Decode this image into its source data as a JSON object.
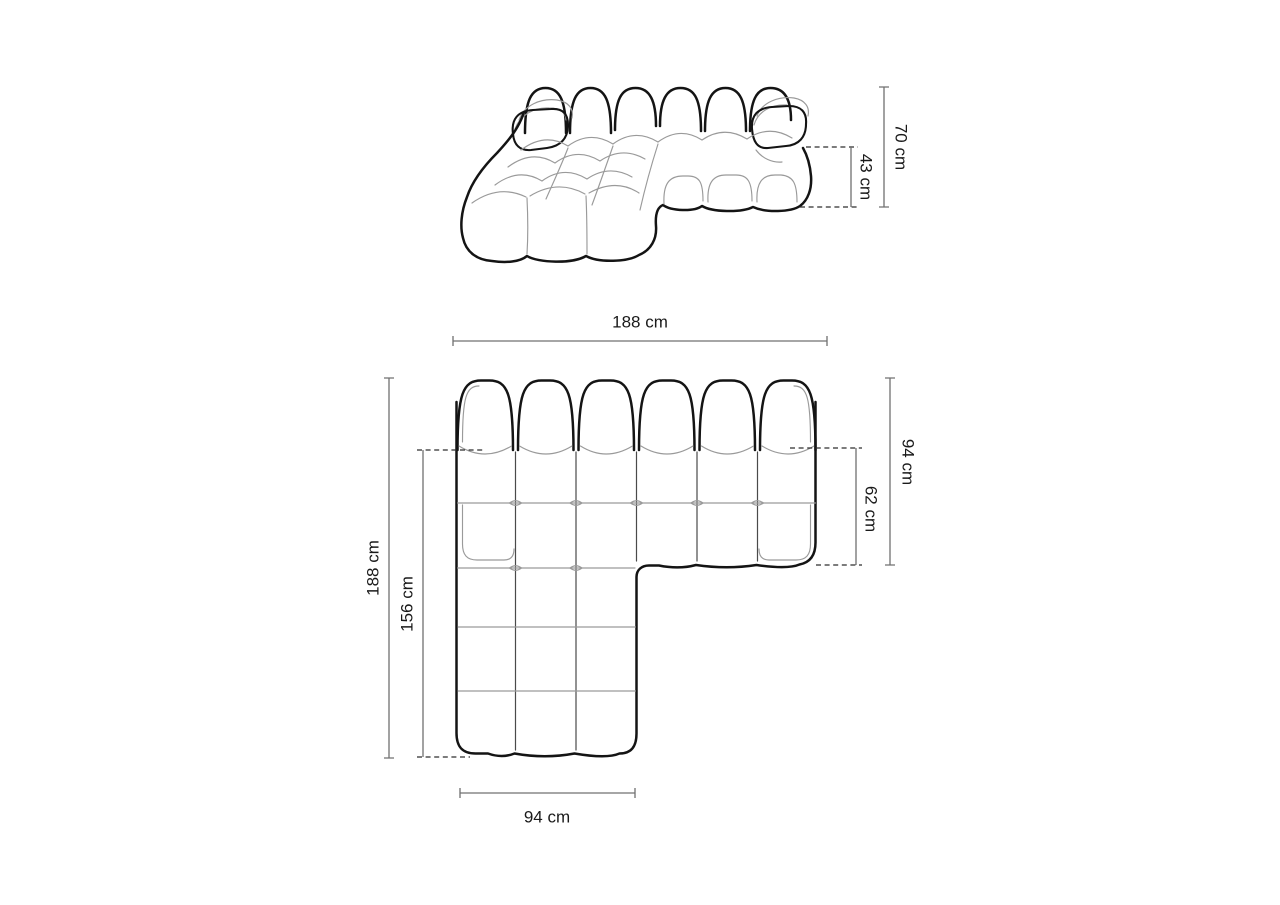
{
  "diagram": {
    "subject": "modular corner sofa dimension drawing",
    "colors": {
      "background": "#ffffff",
      "outline": "#141414",
      "seam": "#9a9a9a",
      "seam_dark": "#4a4a4a",
      "dimension": "#707070",
      "dash": "#2f2f2f",
      "text": "#1a1a1a"
    },
    "views": {
      "side_view": {
        "name": "perspective view",
        "dimensions": [
          {
            "name": "total height",
            "label": "70 cm"
          },
          {
            "name": "armrest / seat height",
            "label": "43 cm"
          }
        ]
      },
      "top_view": {
        "name": "top view",
        "dimensions": [
          {
            "name": "total width",
            "label": "188 cm"
          },
          {
            "name": "total depth",
            "label": "94 cm"
          },
          {
            "name": "seat depth",
            "label": "62 cm"
          },
          {
            "name": "total length left side",
            "label": "188 cm"
          },
          {
            "name": "chaise length",
            "label": "156 cm"
          },
          {
            "name": "chaise width",
            "label": "94 cm"
          }
        ]
      }
    }
  }
}
